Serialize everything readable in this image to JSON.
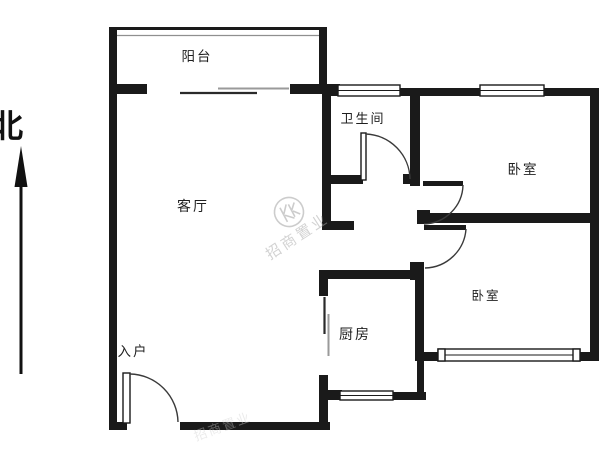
{
  "page": {
    "type": "apartment-floor-plan",
    "background": "#ffffff"
  },
  "compass": {
    "label": "北"
  },
  "rooms": [
    {
      "id": "balcony",
      "label": "阳台"
    },
    {
      "id": "living-room",
      "label": "客厅"
    },
    {
      "id": "bathroom",
      "label": "卫生间"
    },
    {
      "id": "bedroom-top",
      "label": "卧室"
    },
    {
      "id": "bedroom-bottom",
      "label": "卧室"
    },
    {
      "id": "kitchen",
      "label": "厨房"
    },
    {
      "id": "entrance",
      "label": "入户"
    }
  ],
  "watermark": {
    "text": "招商置业"
  },
  "colors": {
    "wall": "#1a1a1a",
    "door_line": "#3a3a3a",
    "label": "#1f1f1f",
    "watermark": "#ababab",
    "background": "#ffffff"
  }
}
